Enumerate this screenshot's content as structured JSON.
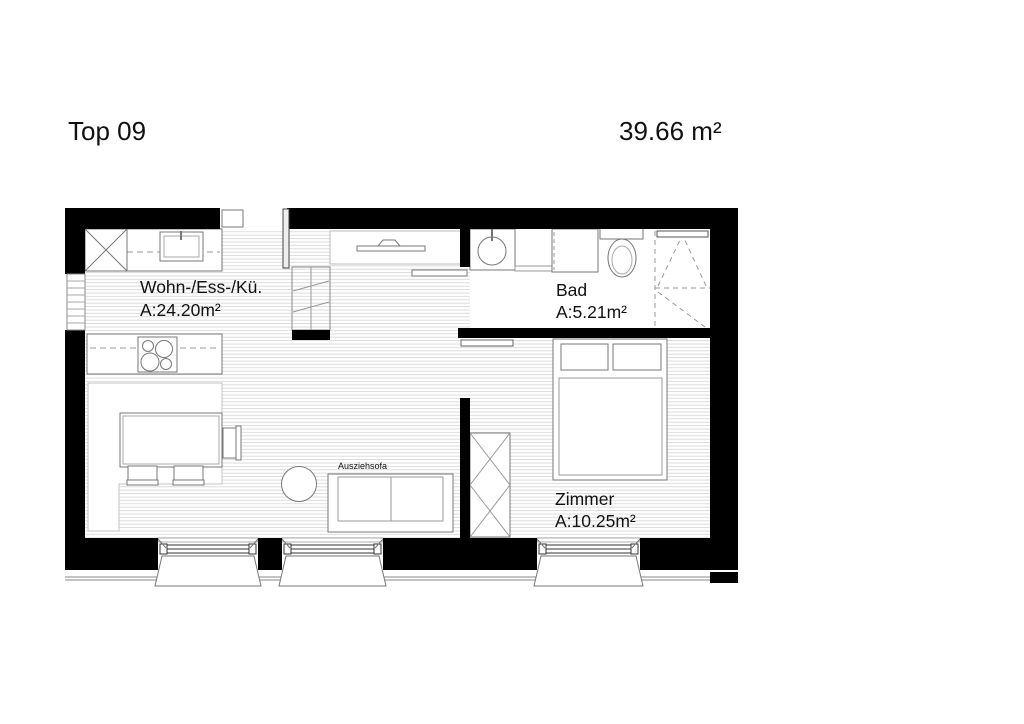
{
  "header": {
    "title": "Top 09",
    "total_area": "39.66 m²"
  },
  "rooms": [
    {
      "name": "Wohn-/Ess-/Kü.",
      "area": "A:24.20m²"
    },
    {
      "name": "Bad",
      "area": "A:5.21m²"
    },
    {
      "name": "Zimmer",
      "area": "A:10.25m²"
    }
  ],
  "labels": {
    "sofa": "Ausziehsofa"
  },
  "colors": {
    "wall": "#000000",
    "furniture_line": "#777777",
    "floor_hatch": "#d8d8d8",
    "text": "#111111",
    "background": "#ffffff"
  }
}
